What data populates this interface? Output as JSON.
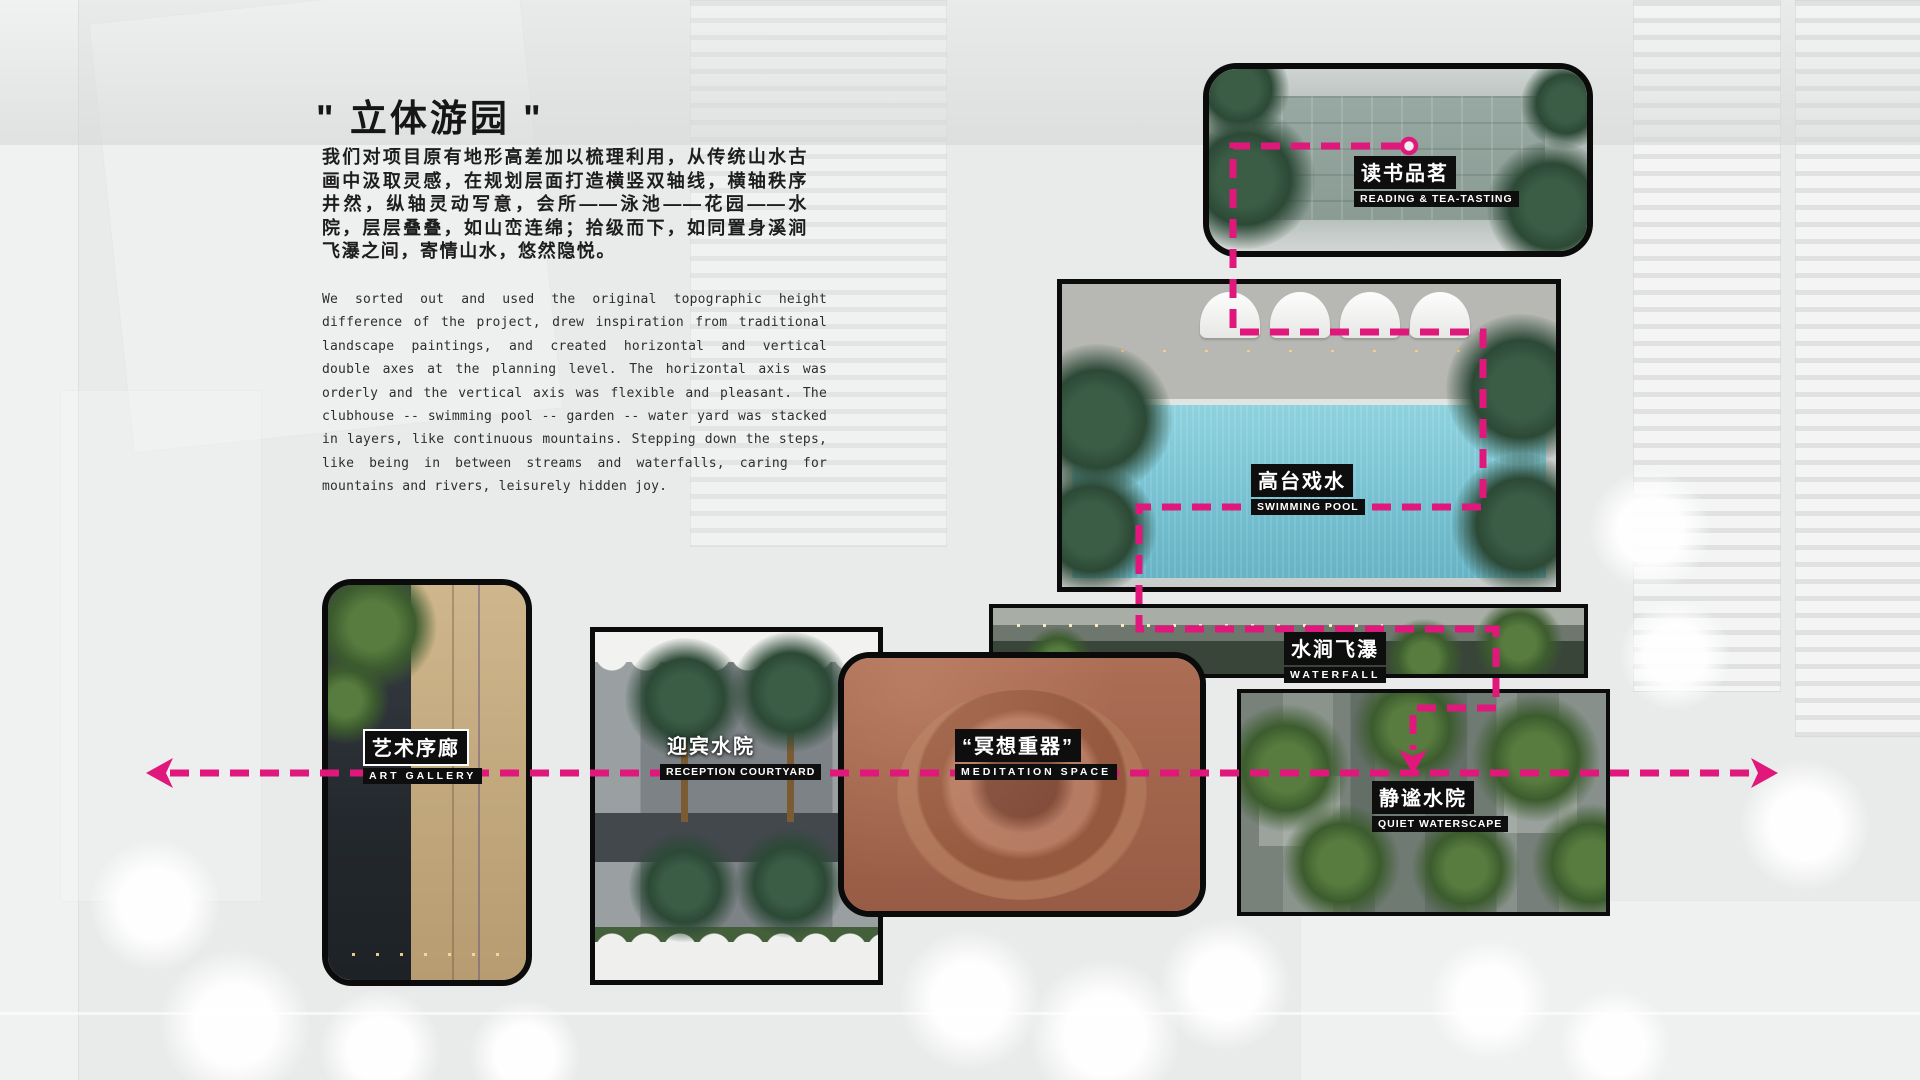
{
  "page": {
    "title": "\" 立体游园 \"",
    "paragraph_zh": "我们对项目原有地形高差加以梳理利用，从传统山水古画中汲取灵感，在规划层面打造横竖双轴线，横轴秩序井然，纵轴灵动写意，会所——泳池——花园——水院，层层叠叠，如山峦连绵；拾级而下，如同置身溪涧飞瀑之间，寄情山水，悠然隐悦。",
    "paragraph_en": "We sorted out and used the original topographic height difference of the project, drew inspiration from traditional landscape paintings, and created horizontal and vertical double axes at the planning level. The horizontal axis was orderly and the vertical axis was flexible and pleasant. The clubhouse -- swimming pool -- garden -- water yard was stacked in layers, like continuous mountains. Stepping down the steps, like being in between streams and waterfalls, caring for mountains and rivers, leisurely hidden joy."
  },
  "labels": {
    "reading": {
      "zh": "读书品茗",
      "en": "READING & TEA-TASTING"
    },
    "pool": {
      "zh": "高台戏水",
      "en": "SWIMMING POOL"
    },
    "waterfall": {
      "zh": "水涧飞瀑",
      "en": "WATERFALL"
    },
    "gallery": {
      "zh": "艺术序廊",
      "en": "ART GALLERY"
    },
    "reception": {
      "zh": "迎宾水院",
      "en": "RECEPTION COURTYARD"
    },
    "meditation": {
      "zh": "“冥想重器”",
      "en": "MEDITATION SPACE"
    },
    "quiet": {
      "zh": "静谧水院",
      "en": "QUIET WATERSCAPE"
    }
  },
  "colors": {
    "accent": "#E0187C",
    "label_bg": "#0E0E0E",
    "label_text": "#FFFFFF",
    "pool_water": "#7EC7D6",
    "meditation_tint": "#A96B54"
  }
}
